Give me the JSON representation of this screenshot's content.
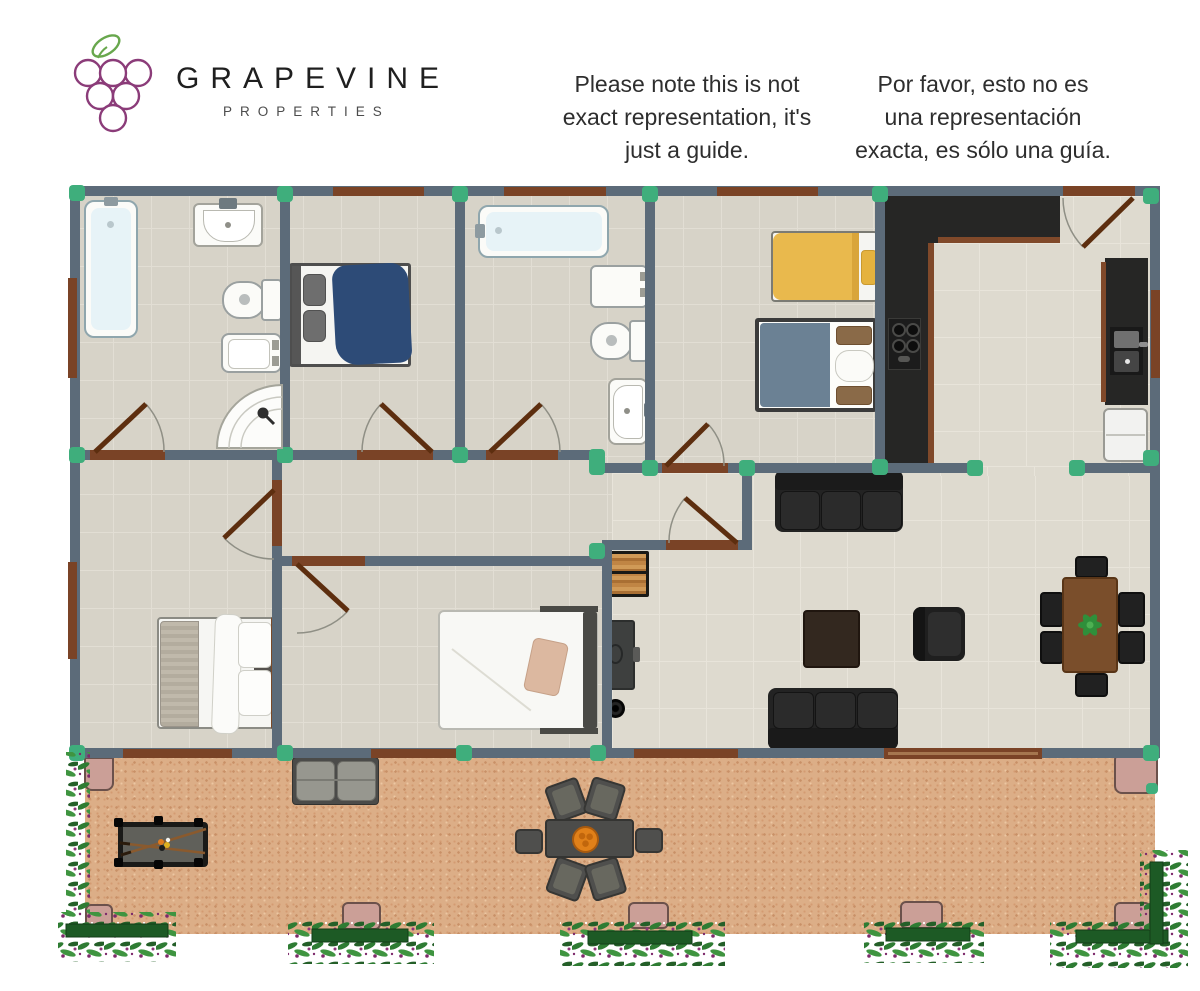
{
  "header": {
    "brand": {
      "name": "GRAPEVINE",
      "tagline": "PROPERTIES"
    },
    "disclaimer_en": {
      "line1": "Please note this is not",
      "line2": "exact representation, it's",
      "line3": "just a guide."
    },
    "disclaimer_es": {
      "line1": "Por favor, esto no es",
      "line2": "una representación",
      "line3": "exacta, es sólo una guía."
    }
  },
  "colors": {
    "wall": "#5c6b79",
    "node": "#3fae7c",
    "window": "#7a4326",
    "door": "#5d2e0f",
    "arc": "#8f8f85",
    "floor": "#d7d3c8",
    "floor_line": "#e2ded4",
    "floor_light": "#dedacf",
    "sand": "#dcae87",
    "step": "#cb9f97",
    "counter": "#262625",
    "counter_edge": "#80492a",
    "sofa_black": "#232323",
    "blanket_navy": "#2d4b77",
    "blanket_yellow": "#e9b94d",
    "blanket_bluegray": "#6b8194",
    "table_brown": "#7a4e2b",
    "pool_felt": "#60605a",
    "centerpiece_orange": "#e08019",
    "vine_green": "#2e7c33",
    "flower_purple": "#7d2a6b",
    "logo_purple": "#8b3c79",
    "leaf_green": "#68a74d",
    "text_dark": "#2e2e2e"
  }
}
